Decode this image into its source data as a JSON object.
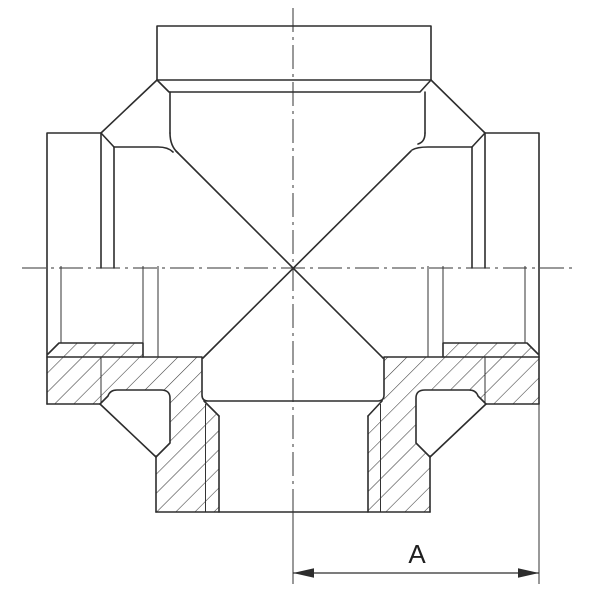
{
  "drawing": {
    "type": "technical-section-drawing",
    "subject": "cross-pipe-fitting",
    "views": "upper half external view, lower half in section with hatching",
    "dimension": {
      "label": "A",
      "measured_from": "vertical-centerline",
      "measured_to": "right-port-face"
    },
    "colors": {
      "background": "#ffffff",
      "line": "#2d2d2d",
      "thin_line": "#333333",
      "hatch": "#3a3a3a",
      "label": "#1f1f1f"
    }
  }
}
